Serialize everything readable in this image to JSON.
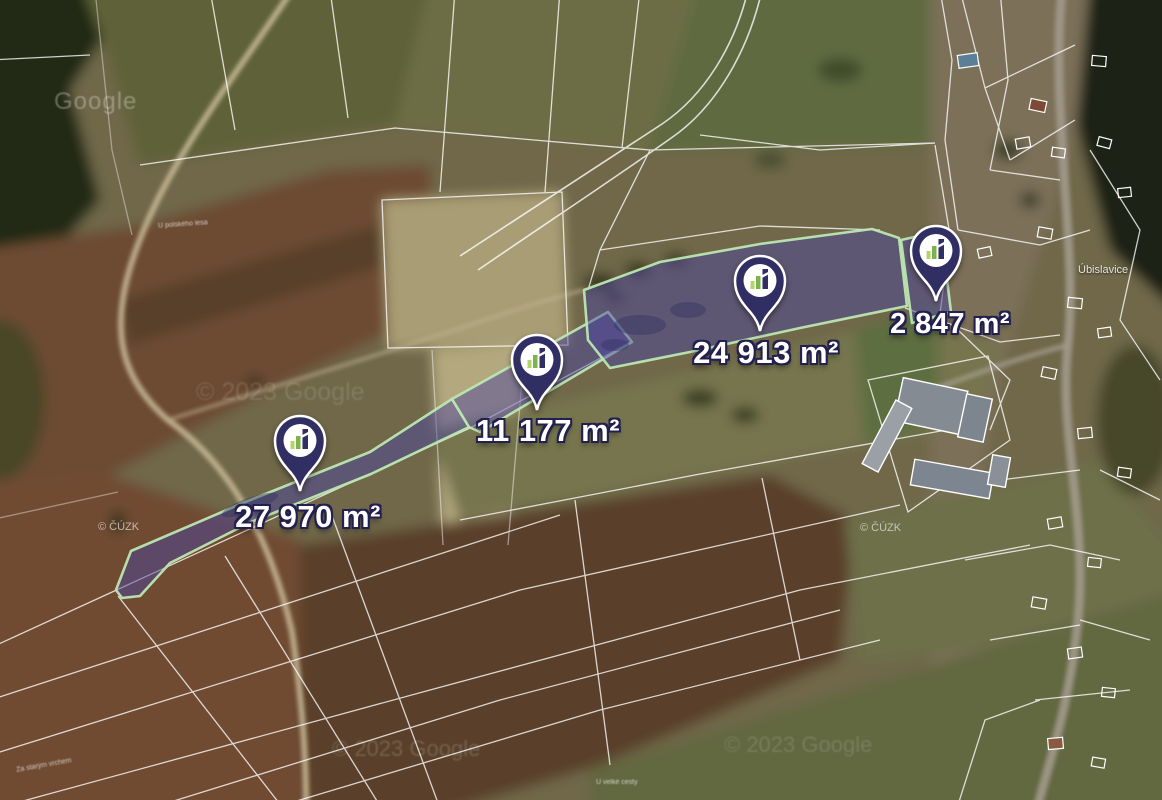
{
  "map": {
    "description": "satellite cadastral map with highlighted land parcels for sale",
    "attribution": {
      "google_logo": "Google",
      "google_copyright": "© 2023 Google",
      "cuzk_copyright": "© ČÚZK"
    },
    "place_labels": {
      "village": "Úbislavice",
      "field_a": "U polského lesa",
      "field_b": "Za starým vrchem",
      "field_c": "U velké cesty"
    }
  },
  "parcels": [
    {
      "id": 1,
      "area_label": "27 970 m²"
    },
    {
      "id": 2,
      "area_label": "11 177 m²"
    },
    {
      "id": 3,
      "area_label": "24 913 m²"
    },
    {
      "id": 4,
      "area_label": "2 847 m²"
    }
  ],
  "icons": {
    "marker": "map-pin-icon",
    "marker_logo": "bar-chart-logo"
  },
  "colors": {
    "pin_body": "#312e63",
    "pin_border": "#ffffff",
    "parcel_fill": "#4c46a0",
    "parcel_border": "#bce7b2",
    "logo_green": "#7db34b",
    "logo_light_green": "#b2d46e",
    "label_text": "#ffffff",
    "label_outline": "#23204f"
  }
}
